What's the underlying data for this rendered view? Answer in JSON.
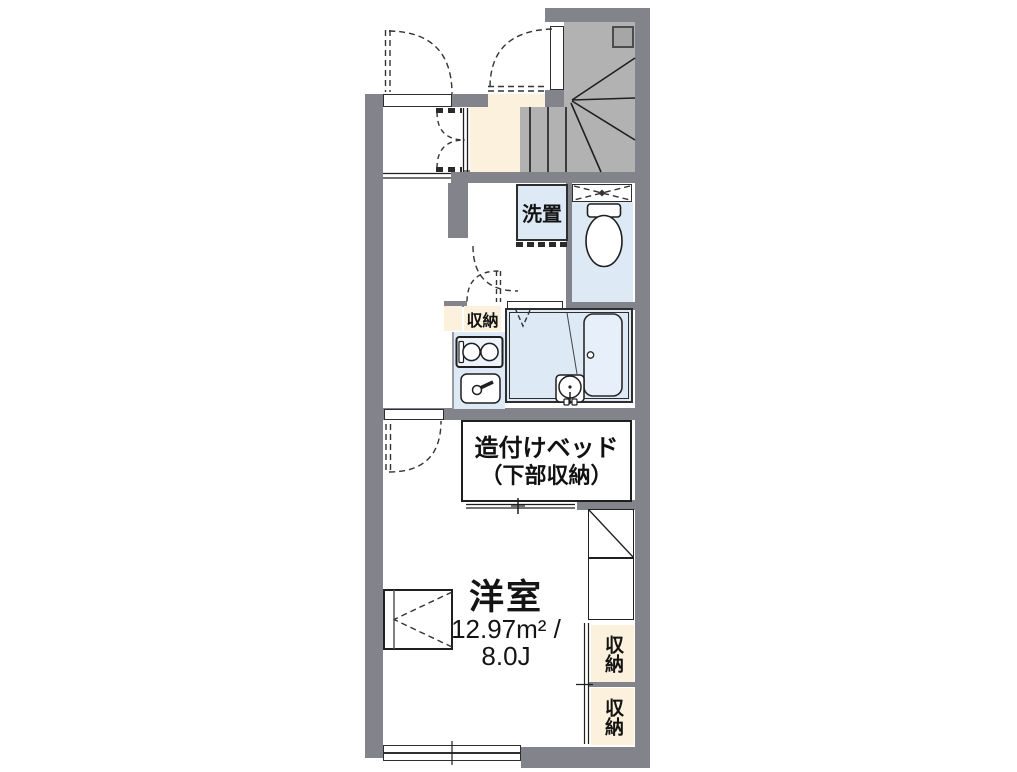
{
  "plan": {
    "type": "floor-plan",
    "labels": {
      "washer": "洗置",
      "storage_kitchen": "収納",
      "bed_line1": "造付けベッド",
      "bed_line2": "（下部収納）",
      "room_name": "洋室",
      "room_area_m2": "12.97m² /",
      "room_area_jo": "8.0J",
      "storage_right_top": "収納",
      "storage_right_bottom": "収納"
    },
    "colors": {
      "wall": "#83838B",
      "stair": "#B2B2B2",
      "stairSq": "#A6A6A6",
      "cream": "#FBF1DC",
      "blue": "#DEE9F6",
      "line": "#1F1F1F"
    }
  }
}
